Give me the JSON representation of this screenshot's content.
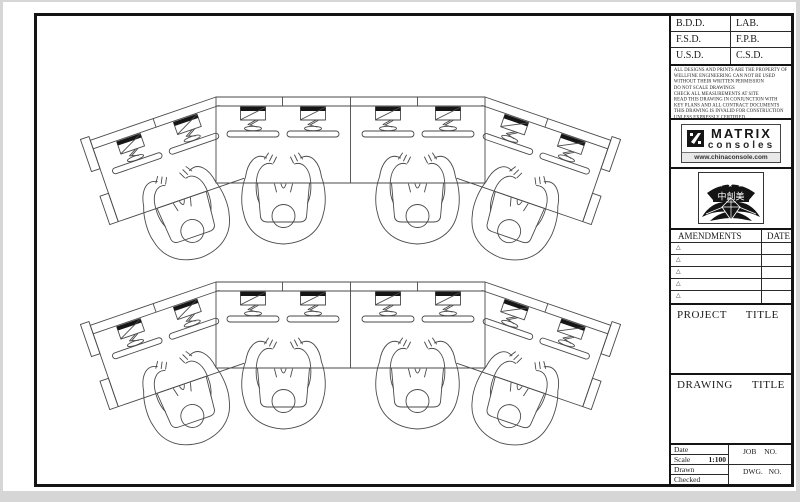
{
  "title_block": {
    "approvals": {
      "rows": [
        [
          "B.D.D.",
          "LAB."
        ],
        [
          "F.S.D.",
          "F.P.B."
        ],
        [
          "U.S.D.",
          "C.S.D."
        ]
      ]
    },
    "notes_text": "ALL DESIGNS AND PRINTS ARE THE PROPERTY OF\nWELLFINE ENGINEERING CAN NOT BE USED\nWITHOUT THEIR WRITTEN PERMISSION\nDO NOT SCALE DRAWINGS\nCHECK ALL MEASUREMENTS AT SITE\nREAD THIS DRAWING IN CONJUNCTION WITH\nKEY PLANS AND ALL CONTRACT DOCUMENTS\nTHIS DRAWING IS INVALID FOR CONSTRUCTION\nUNLESS EXPRESSLY CERTIFIED",
    "brand": {
      "name": "MATRIX",
      "product": "consoles",
      "url": "www.chinaconsole.com"
    },
    "badge": {
      "stars": "★ ★ ★ ★ ★",
      "chars": "中創美"
    },
    "amendments": {
      "title": "AMENDMENTS",
      "date_label": "DATE",
      "marker": "△",
      "row_count": 5
    },
    "project_label": "PROJECT TITLE",
    "drawing_label": "DRAWING TITLE",
    "info": {
      "date_label": "Date",
      "scale_label": "Scale",
      "scale_value": "1:100",
      "drawn_label": "Drawn",
      "checked_label": "Checked",
      "job_label": "JOB NO.",
      "dwg_label": "DWG. NO."
    }
  },
  "colors": {
    "frame": "#141414",
    "cad_line": "#4a4a4a",
    "paper": "#ffffff"
  }
}
